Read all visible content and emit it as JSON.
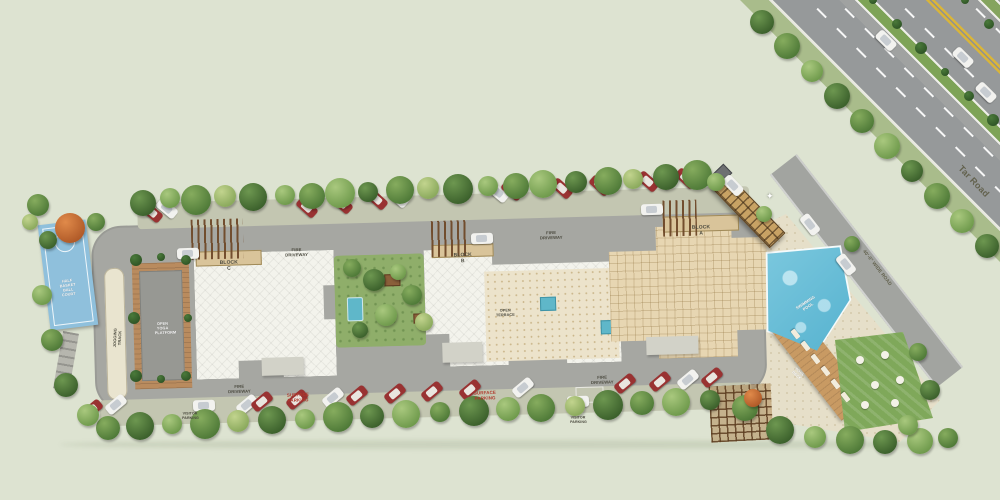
{
  "meta": {
    "title": "Residential site master plan render"
  },
  "labels": {
    "block_a": "BLOCK A",
    "block_b": "BLOCK B",
    "block_c": "BLOCK C",
    "fire_driveway": "FIRE DRIVEWAY",
    "surface_parking": "SURFACE PARKING",
    "half_basketball_court": "HALF\nBASKET BALL\nCOURT",
    "open_yoga_platform": "OPEN\nYOGA\nPLATFORM",
    "jogging_track": "JOGGING TRACK",
    "swimming_pool": "SWIMMING POOL",
    "pool_deck": "POOL DECK",
    "open_terrace": "OPEN TERRACE",
    "tar_road": "Tar Road",
    "wide_road": "40'-0\" WIDE ROAD",
    "visitor_parking": "VISITOR\nPARKING",
    "gate_star": "✦"
  },
  "colors": {
    "background": "#dde3d1",
    "road": "#a6a7a2",
    "highway": "#96999a",
    "verge_green": "#a9bc8b",
    "median_green": "#7da356",
    "lane_yellow": "#d9b53a",
    "roof_white": "#f3f3ec",
    "roof_tan": "#e7d6b2",
    "paving_cream": "#ece3cb",
    "wood": "#b98b5e",
    "pool_blue": "#62bcd8",
    "court_blue": "#8fc0dc",
    "lawn_green": "#7fa85a",
    "car_red": "#993232",
    "label_dark": "#4a493e",
    "label_red": "#b03a2e"
  }
}
